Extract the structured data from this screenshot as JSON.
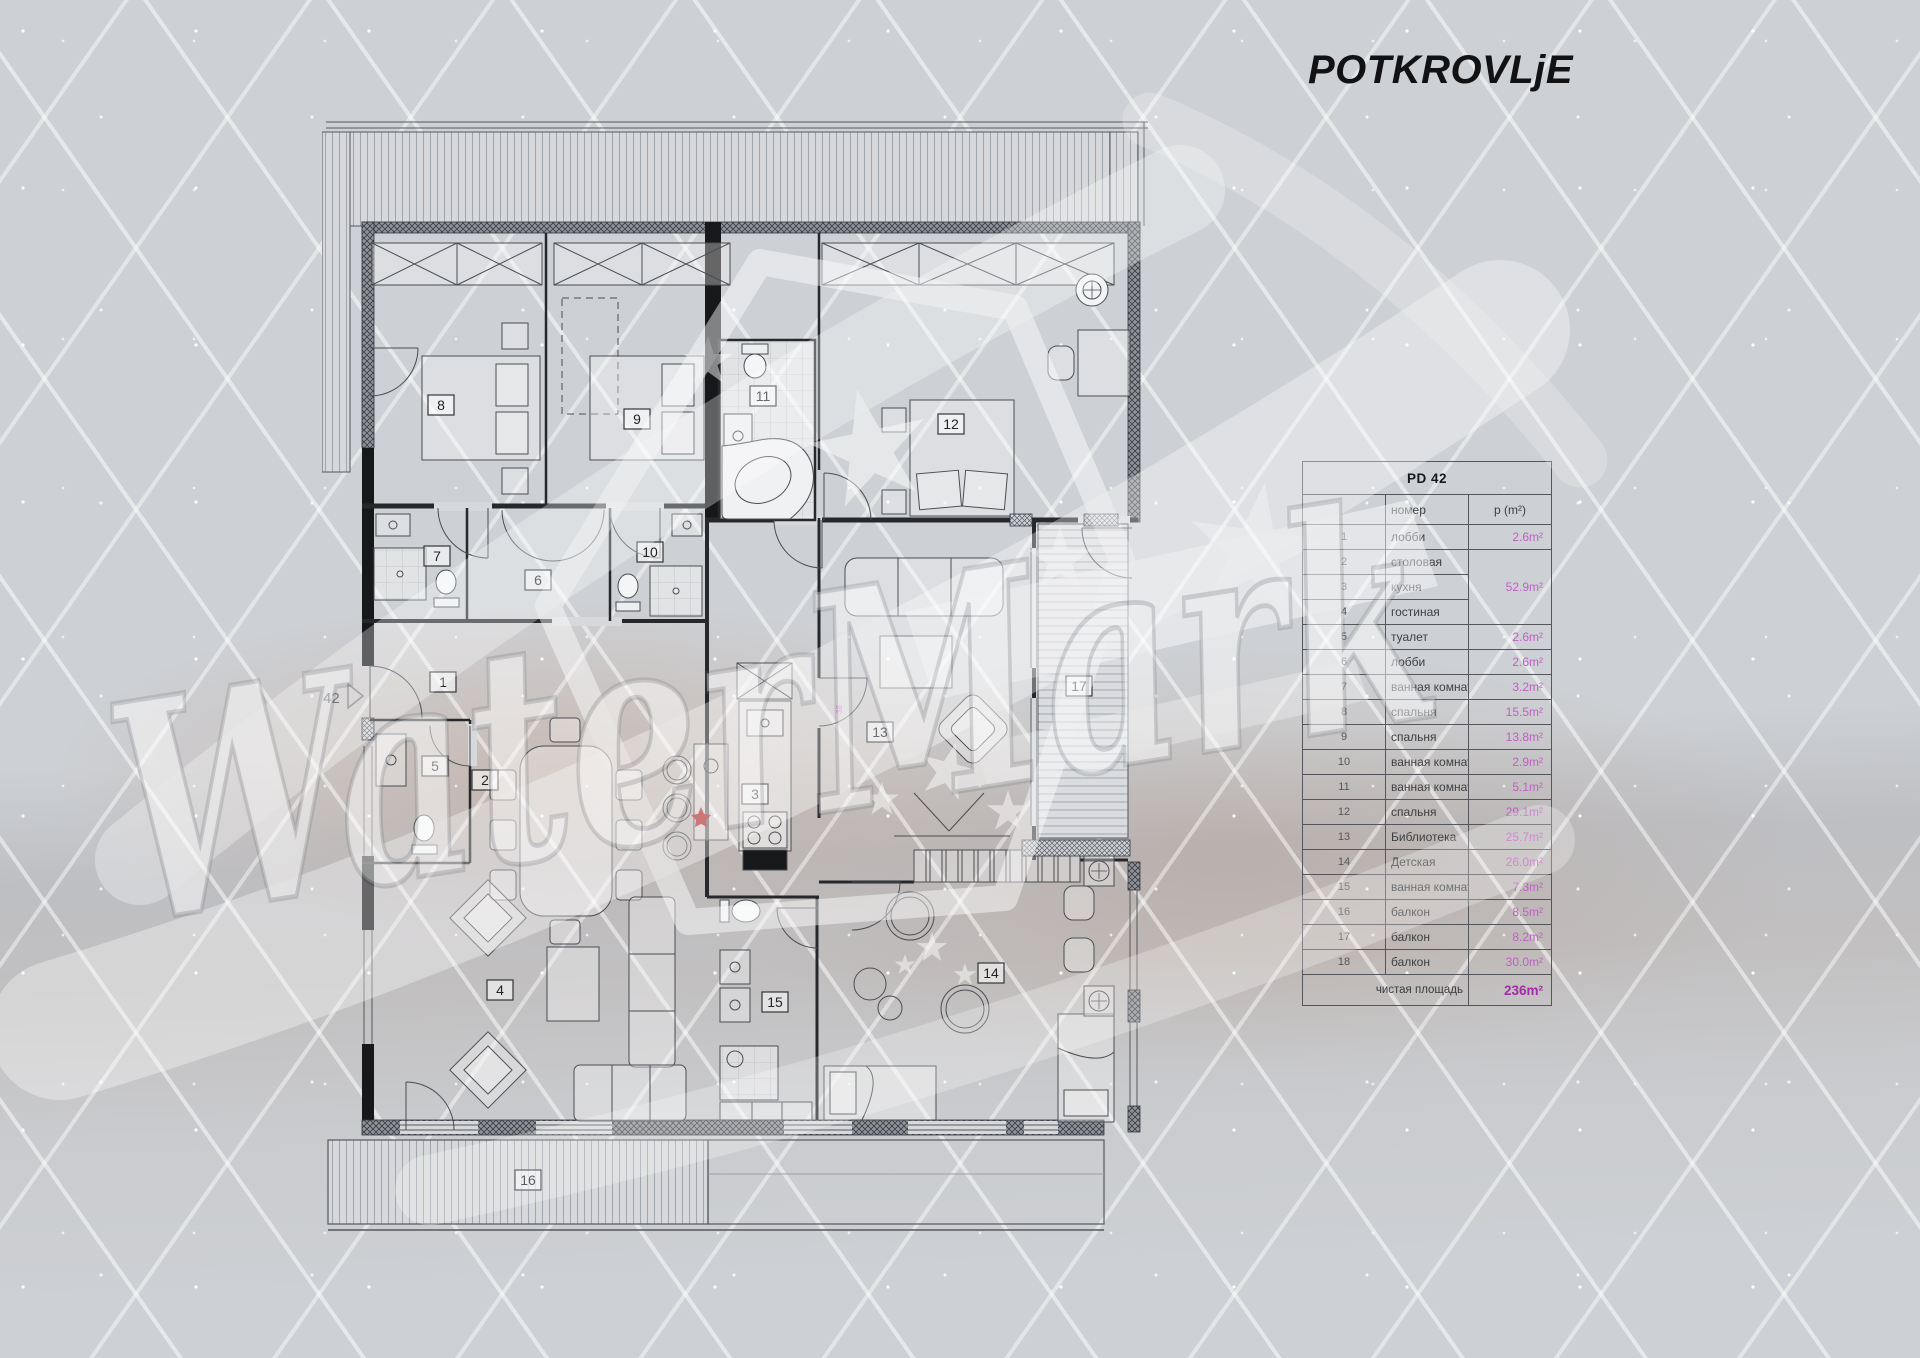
{
  "page": {
    "title": "POTKROVLjE"
  },
  "watermark": {
    "text": "WaterMark"
  },
  "plan": {
    "apartment_number": "42",
    "dim_label": "38",
    "room_numbers": [
      "1",
      "2",
      "3",
      "4",
      "5",
      "6",
      "7",
      "8",
      "9",
      "10",
      "11",
      "12",
      "13",
      "14",
      "15",
      "16",
      "17",
      "18"
    ]
  },
  "table": {
    "title": "PD 42",
    "col_room": "номер",
    "col_area": "p (m²)",
    "rows": [
      {
        "num": "1",
        "name": "лобби",
        "area": "2.6m²"
      },
      {
        "num": "2",
        "name": "столовая",
        "area": ""
      },
      {
        "num": "3",
        "name": "кухня",
        "area": "52.9m²"
      },
      {
        "num": "4",
        "name": "гостиная",
        "area": ""
      },
      {
        "num": "5",
        "name": "туалет",
        "area": "2.6m²"
      },
      {
        "num": "6",
        "name": "лобби",
        "area": "2.6m²"
      },
      {
        "num": "7",
        "name": "ванная комната",
        "area": "3.2m²"
      },
      {
        "num": "8",
        "name": "спальня",
        "area": "15.5m²"
      },
      {
        "num": "9",
        "name": "спальня",
        "area": "13.8m²"
      },
      {
        "num": "10",
        "name": "ванная комната",
        "area": "2.9m²"
      },
      {
        "num": "11",
        "name": "ванная комната",
        "area": "5.1m²"
      },
      {
        "num": "12",
        "name": "спальня",
        "area": "29.1m²"
      },
      {
        "num": "13",
        "name": "Библиотека",
        "area": "25.7m²"
      },
      {
        "num": "14",
        "name": "Детская",
        "area": "26.0m²"
      },
      {
        "num": "15",
        "name": "ванная комната",
        "area": "7.3m²"
      },
      {
        "num": "16",
        "name": "балкон",
        "area": "8.5m²"
      },
      {
        "num": "17",
        "name": "балкон",
        "area": "8.2m²"
      },
      {
        "num": "18",
        "name": "балкон",
        "area": "30.0m²"
      }
    ],
    "total_label": "чистая площадь",
    "total_value": "236m²"
  },
  "colors": {
    "area_value": "#c05fc3",
    "total_value": "#a42ba8",
    "title_text": "#121215",
    "background": "#cdd0d4"
  }
}
